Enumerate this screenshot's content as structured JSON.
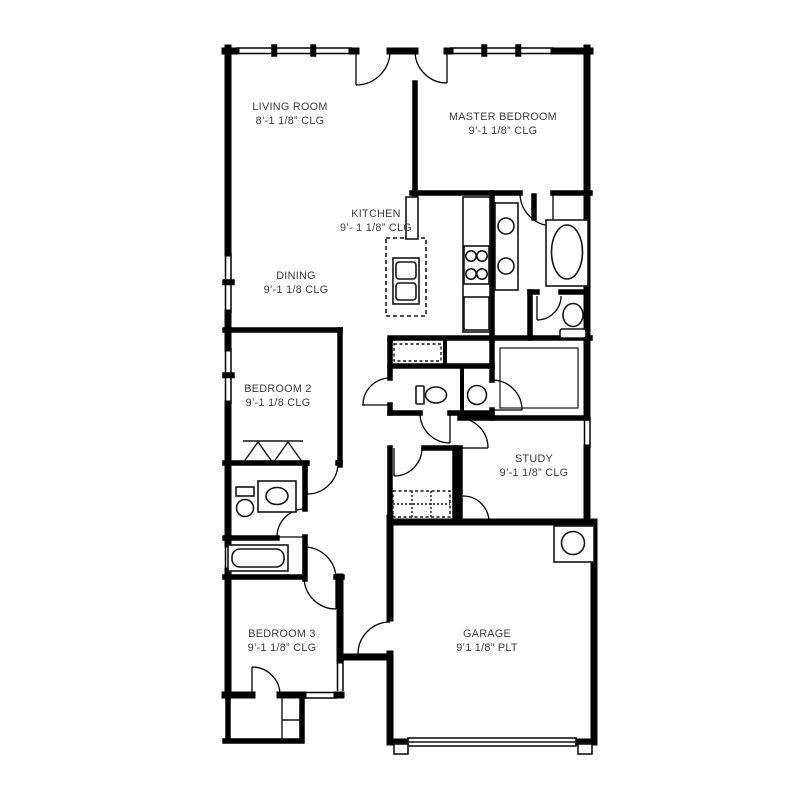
{
  "page": {
    "background": "#ffffff",
    "description": "single-story house floor plan"
  },
  "colors": {
    "wall": "#000000",
    "fixture_stroke": "#141414",
    "label_text": "#3a3a3a"
  },
  "rooms": [
    {
      "id": "living-room",
      "name": "LIVING ROOM",
      "ceiling": "8’-1 1/8” CLG"
    },
    {
      "id": "master-bedroom",
      "name": "MASTER BEDROOM",
      "ceiling": "9’-1 1/8” CLG"
    },
    {
      "id": "kitchen",
      "name": "KITCHEN",
      "ceiling": "9’- 1 1/8” CLG"
    },
    {
      "id": "dining",
      "name": "DINING",
      "ceiling": "9’-1 1/8 CLG"
    },
    {
      "id": "bedroom-2",
      "name": "BEDROOM 2",
      "ceiling": "9’-1 1/8 CLG"
    },
    {
      "id": "study",
      "name": "STUDY",
      "ceiling": "9’-1 1/8” CLG"
    },
    {
      "id": "bedroom-3",
      "name": "BEDROOM 3",
      "ceiling": "9’-1 1/8” CLG"
    },
    {
      "id": "garage",
      "name": "GARAGE",
      "ceiling": "9’1 1/8” PLT"
    }
  ],
  "fixtures": [
    "kitchen-island",
    "range-oven",
    "cooktop-4-burner",
    "refrigerator",
    "pantry-cabinet",
    "master-double-vanity",
    "master-bathtub",
    "master-toilet",
    "powder-toilet",
    "powder-round-sink",
    "bath2-vanity",
    "bath2-toilet",
    "bath2-tub",
    "bifold-closet-doors",
    "linen-shelves-dashed",
    "utility-shelves-dashed",
    "water-heater",
    "garage-overhead-door",
    "window",
    "door-swing"
  ]
}
